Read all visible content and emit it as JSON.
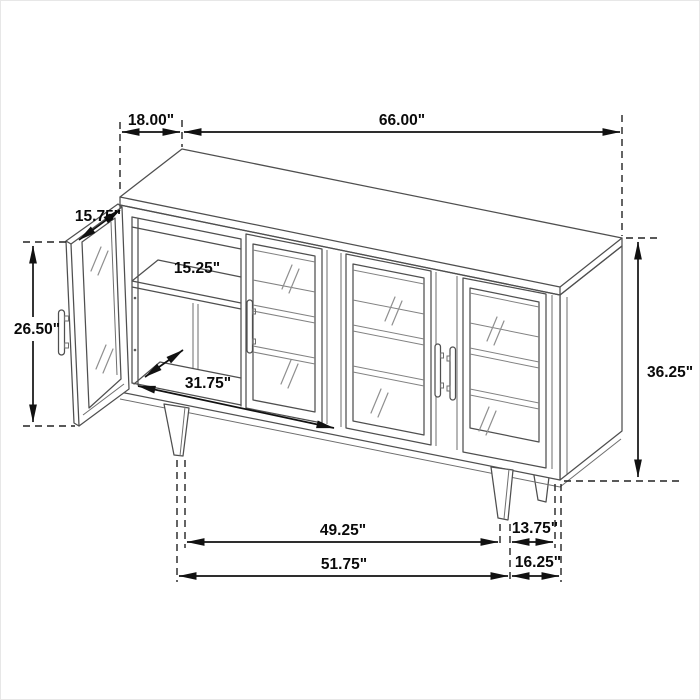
{
  "diagram": {
    "subject": "sideboard-cabinet-dimension-drawing",
    "unit": "inches",
    "colors": {
      "background": "#ffffff",
      "cabinet_line": "#4f4f4f",
      "dimension_line": "#111111",
      "glass_detail": "#828282"
    },
    "dimensions": {
      "top_depth": "18.00\"",
      "top_width": "66.00\"",
      "door_width": "15.75\"",
      "door_height": "26.50\"",
      "shelf_depth": "15.25\"",
      "interior_width": "31.75\"",
      "overall_height": "36.25\"",
      "leg_span_inner": "49.25\"",
      "leg_to_edge_upper": "13.75\"",
      "leg_span_outer": "51.75\"",
      "leg_to_edge_lower": "16.25\""
    }
  }
}
